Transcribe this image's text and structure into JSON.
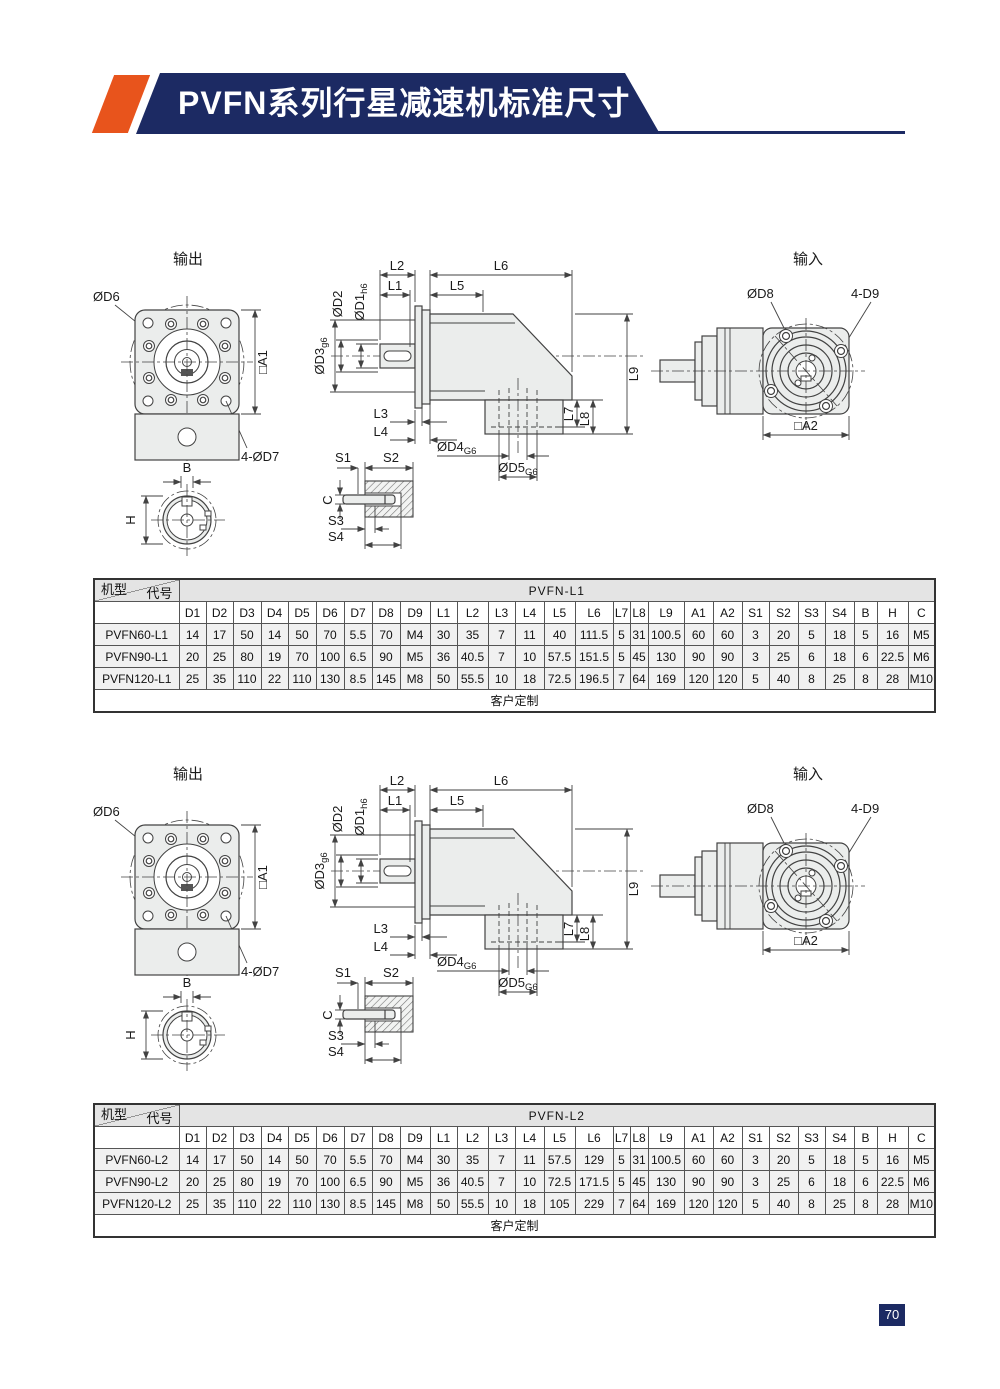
{
  "header": {
    "title": "PVFN系列行星减速机标准尺寸"
  },
  "page": {
    "number": "70"
  },
  "drawing": {
    "output_title": "输出",
    "input_title": "输入",
    "d6": "ØD6",
    "a1": "□A1",
    "d7": "4-ØD7",
    "b": "B",
    "h": "H",
    "d2": "ØD2",
    "d1_main": "ØD1",
    "d1_sub": "h6",
    "d3_main": "ØD3",
    "d3_sub": "g6",
    "l1": "L1",
    "l2": "L2",
    "l3": "L3",
    "l4": "L4",
    "l5": "L5",
    "l6": "L6",
    "l7": "L7",
    "l8": "L8",
    "l9": "L9",
    "d4_main": "ØD4",
    "d4_sub": "G6",
    "d5_main": "ØD5",
    "d5_sub": "G6",
    "s1": "S1",
    "s2": "S2",
    "s3": "S3",
    "s4": "S4",
    "c": "C",
    "d8": "ØD8",
    "d9": "4-D9",
    "a2": "□A2"
  },
  "tables": [
    {
      "title": "PVFN-L1",
      "corner_top": "代号",
      "corner_bottom": "机型",
      "columns": [
        "D1",
        "D2",
        "D3",
        "D4",
        "D5",
        "D6",
        "D7",
        "D8",
        "D9",
        "L1",
        "L2",
        "L3",
        "L4",
        "L5",
        "L6",
        "L7",
        "L8",
        "L9",
        "A1",
        "A2",
        "S1",
        "S2",
        "S3",
        "S4",
        "B",
        "H",
        "C"
      ],
      "rows": [
        {
          "model": "PVFN60-L1",
          "values": [
            "14",
            "17",
            "50",
            "14",
            "50",
            "70",
            "5.5",
            "70",
            "M4",
            "30",
            "35",
            "7",
            "11",
            "40",
            "111.5",
            "5",
            "31",
            "100.5",
            "60",
            "60",
            "3",
            "20",
            "5",
            "18",
            "5",
            "16",
            "M5"
          ]
        },
        {
          "model": "PVFN90-L1",
          "values": [
            "20",
            "25",
            "80",
            "19",
            "70",
            "100",
            "6.5",
            "90",
            "M5",
            "36",
            "40.5",
            "7",
            "10",
            "57.5",
            "151.5",
            "5",
            "45",
            "130",
            "90",
            "90",
            "3",
            "25",
            "6",
            "18",
            "6",
            "22.5",
            "M6"
          ]
        },
        {
          "model": "PVFN120-L1",
          "values": [
            "25",
            "35",
            "110",
            "22",
            "110",
            "130",
            "8.5",
            "145",
            "M8",
            "50",
            "55.5",
            "10",
            "18",
            "72.5",
            "196.5",
            "7",
            "64",
            "169",
            "120",
            "120",
            "5",
            "40",
            "8",
            "25",
            "8",
            "28",
            "M10"
          ]
        }
      ],
      "footer": "客户定制"
    },
    {
      "title": "PVFN-L2",
      "corner_top": "代号",
      "corner_bottom": "机型",
      "columns": [
        "D1",
        "D2",
        "D3",
        "D4",
        "D5",
        "D6",
        "D7",
        "D8",
        "D9",
        "L1",
        "L2",
        "L3",
        "L4",
        "L5",
        "L6",
        "L7",
        "L8",
        "L9",
        "A1",
        "A2",
        "S1",
        "S2",
        "S3",
        "S4",
        "B",
        "H",
        "C"
      ],
      "rows": [
        {
          "model": "PVFN60-L2",
          "values": [
            "14",
            "17",
            "50",
            "14",
            "50",
            "70",
            "5.5",
            "70",
            "M4",
            "30",
            "35",
            "7",
            "11",
            "57.5",
            "129",
            "5",
            "31",
            "100.5",
            "60",
            "60",
            "3",
            "20",
            "5",
            "18",
            "5",
            "16",
            "M5"
          ]
        },
        {
          "model": "PVFN90-L2",
          "values": [
            "20",
            "25",
            "80",
            "19",
            "70",
            "100",
            "6.5",
            "90",
            "M5",
            "36",
            "40.5",
            "7",
            "10",
            "72.5",
            "171.5",
            "5",
            "45",
            "130",
            "90",
            "90",
            "3",
            "25",
            "6",
            "18",
            "6",
            "22.5",
            "M6"
          ]
        },
        {
          "model": "PVFN120-L2",
          "values": [
            "25",
            "35",
            "110",
            "22",
            "110",
            "130",
            "8.5",
            "145",
            "M8",
            "50",
            "55.5",
            "10",
            "18",
            "105",
            "229",
            "7",
            "64",
            "169",
            "120",
            "120",
            "5",
            "40",
            "8",
            "25",
            "8",
            "28",
            "M10"
          ]
        }
      ],
      "footer": "客户定制"
    }
  ]
}
